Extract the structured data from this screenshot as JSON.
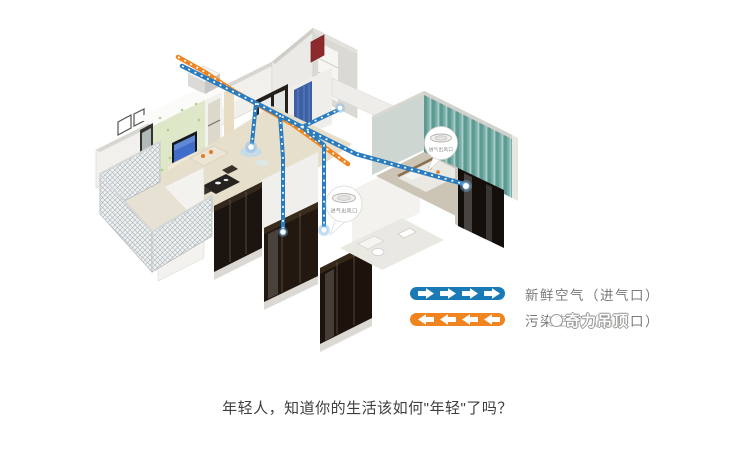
{
  "illustration": {
    "callouts": [
      {
        "label": "进气出风口"
      },
      {
        "label": "进气出风口"
      }
    ]
  },
  "legend": {
    "fresh": {
      "label": "新鲜空气（进气口）",
      "color": "#1a7ab5",
      "direction": "right"
    },
    "polluted": {
      "label": "污染空气（排气口）",
      "color": "#f08520",
      "direction": "left"
    },
    "watermark": "奇力吊顶"
  },
  "caption": {
    "text": "年轻人，知道你的生活该如何\"年轻\"了吗？"
  }
}
